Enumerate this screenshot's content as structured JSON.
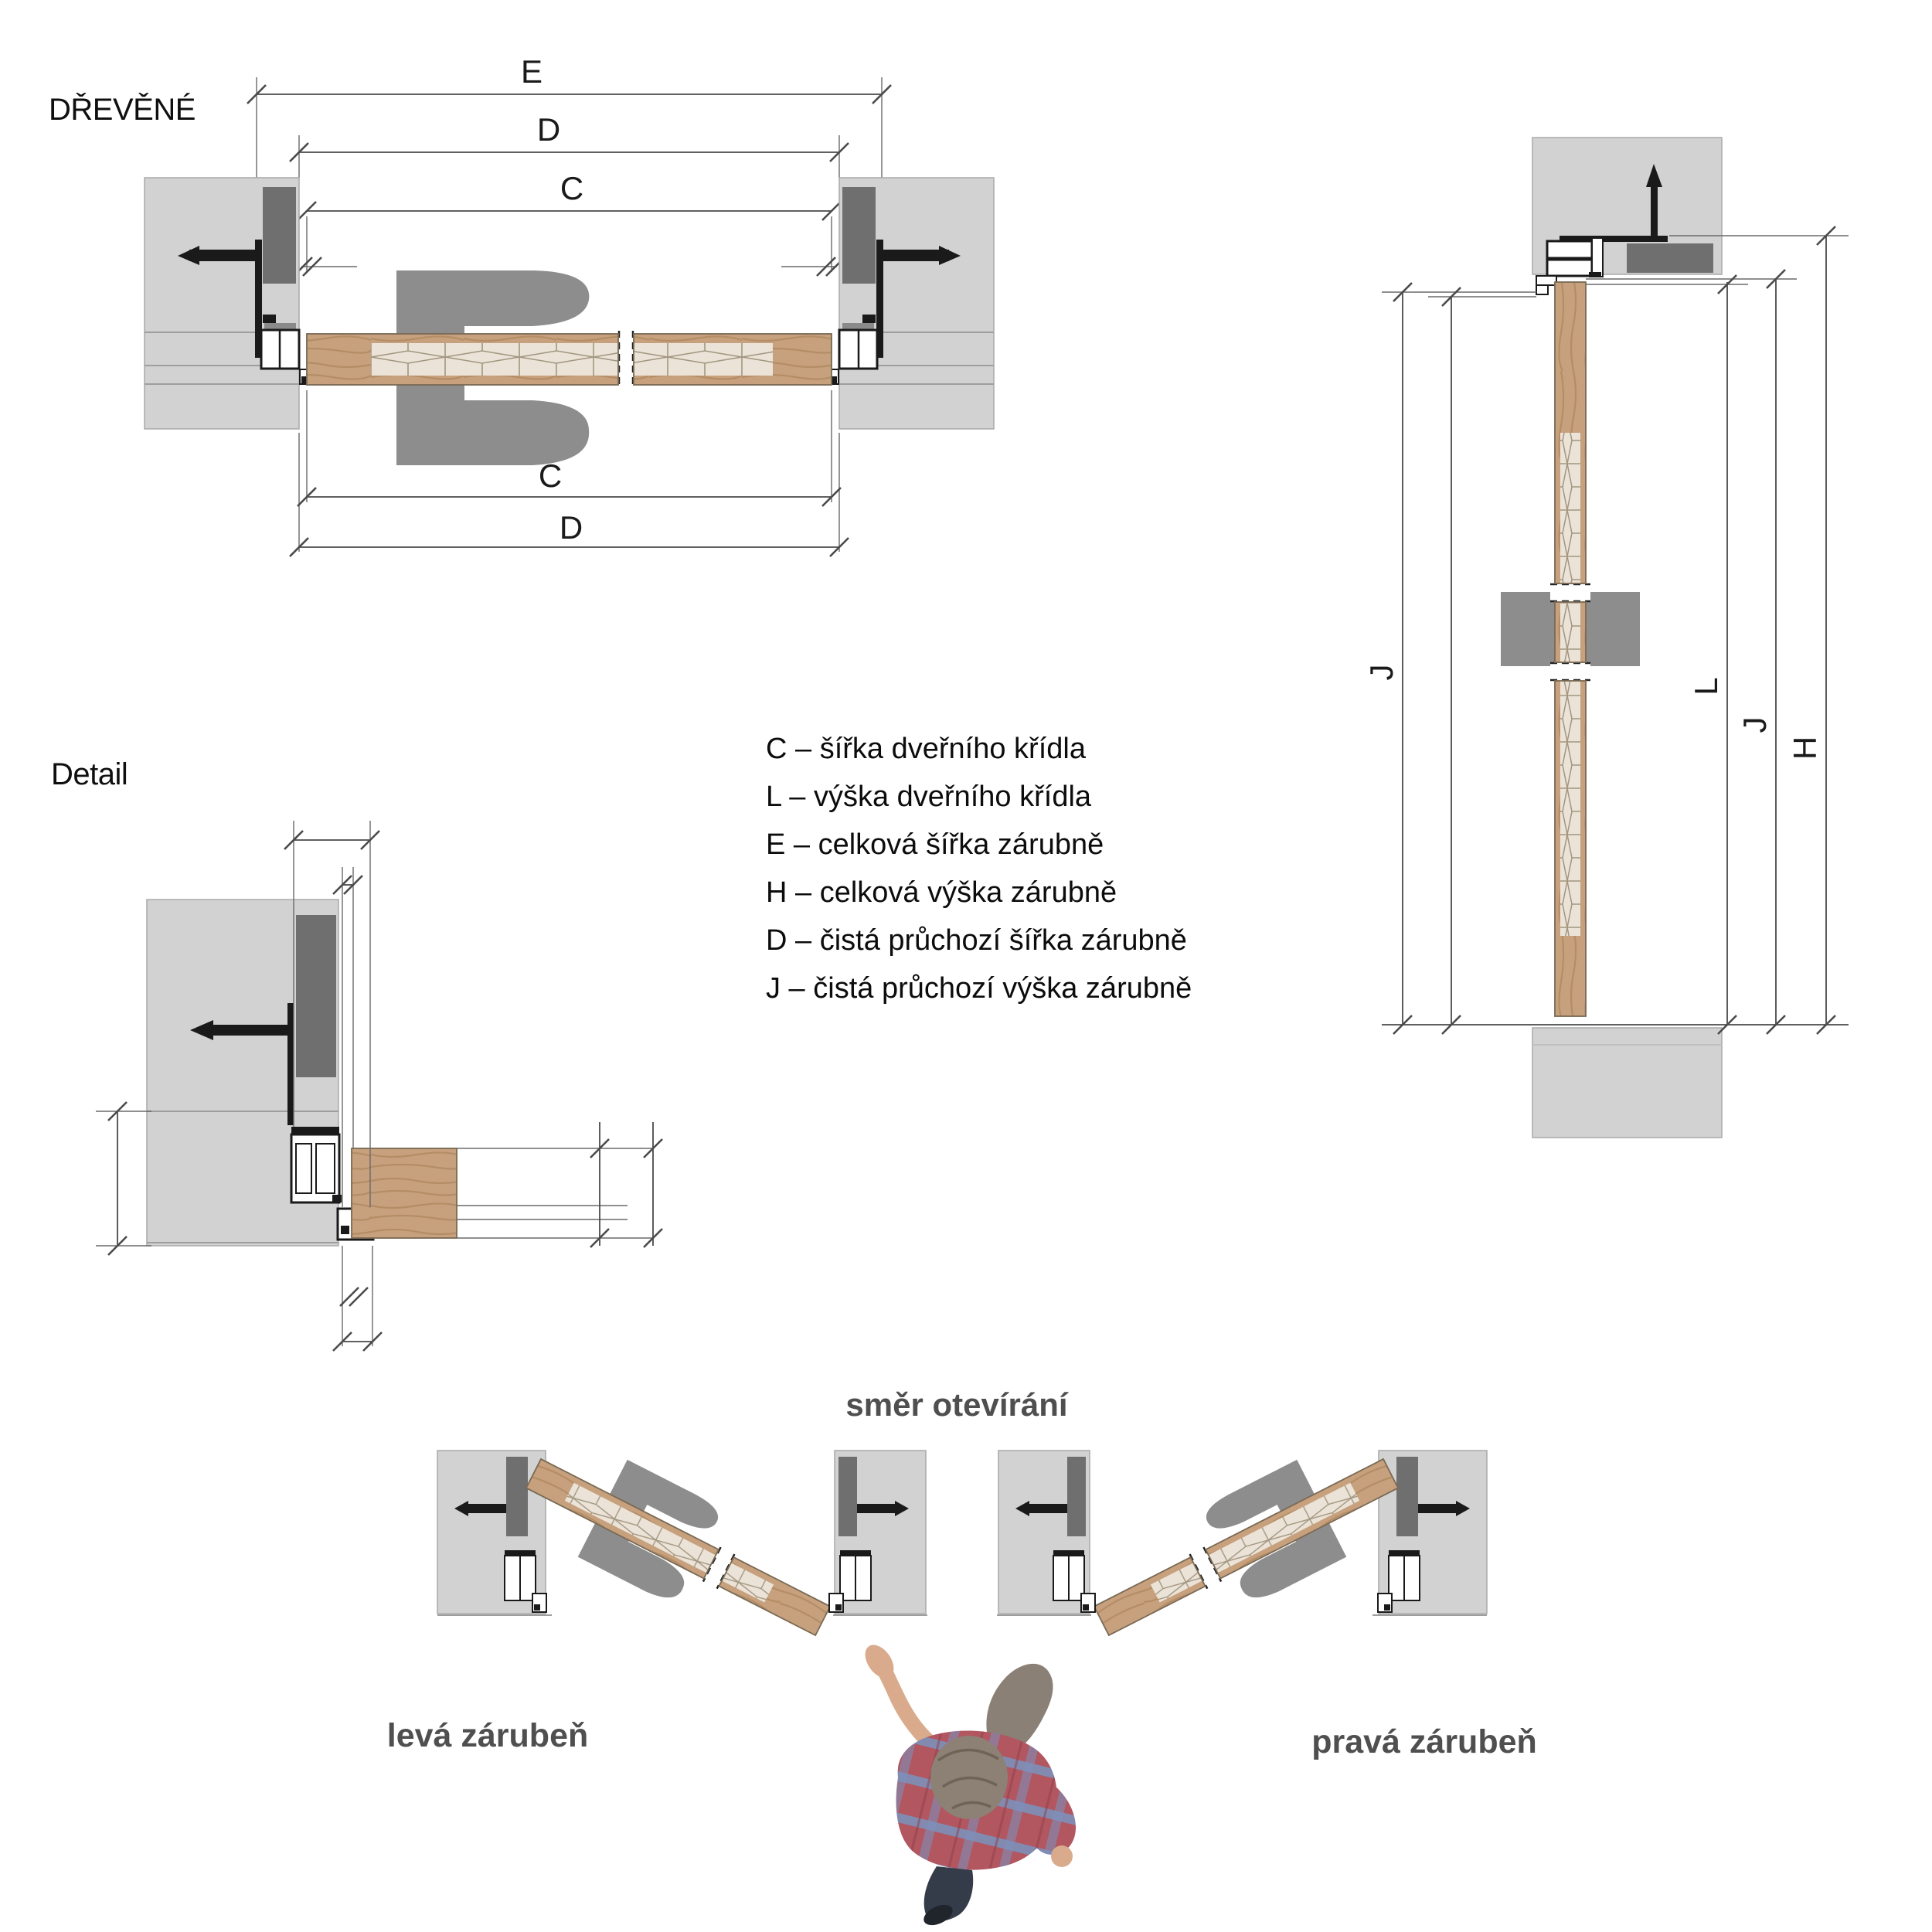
{
  "labels": {
    "material": "DŘEVĚNÉ",
    "detail": "Detail",
    "direction": "směr otevírání",
    "left_frame": "levá zárubeň",
    "right_frame": "pravá zárubeň"
  },
  "dims": {
    "C": "C",
    "D": "D",
    "E": "E",
    "H": "H",
    "J": "J",
    "L": "L"
  },
  "legend": {
    "items": [
      {
        "key": "C",
        "text": "C – šířka dveřního křídla"
      },
      {
        "key": "L",
        "text": "L – výška dveřního křídla"
      },
      {
        "key": "E",
        "text": "E – celková šířka zárubně"
      },
      {
        "key": "H",
        "text": "H – celková výška zárubně"
      },
      {
        "key": "D",
        "text": "D – čistá průchozí šířka zárubně"
      },
      {
        "key": "J",
        "text": "J – čistá průchozí výška zárubně"
      }
    ]
  },
  "colors": {
    "wall": "#d2d2d2",
    "plate": "#6f6f6f",
    "handle": "#8d8d8d",
    "wood": "#c7a17d",
    "core": "#ece3d8",
    "ink": "#1a1a1a",
    "dim": "#4a4a4a",
    "label": "#4f4f4f"
  }
}
